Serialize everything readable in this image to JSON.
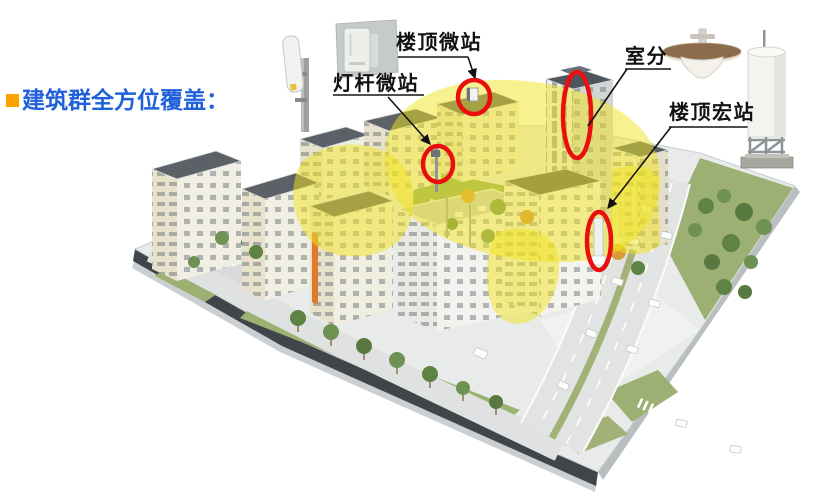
{
  "slide": {
    "title": "建筑群全方位覆盖：",
    "colors": {
      "title": "#2160DB",
      "bullet": "#FFA200",
      "marker": "#E90F0F",
      "coverage": "#F2E320"
    }
  },
  "labels": {
    "rooftop_micro": "楼顶微站",
    "pole_micro": "灯杆微站",
    "indoor": "室分",
    "rooftop_macro": "楼顶宏站"
  },
  "icons": {
    "pole_antenna": "pole-micro-antenna-icon",
    "wall_micro": "wall-mounted-micro-station-icon",
    "ceiling_antenna": "indoor-ceiling-antenna-icon",
    "macro_tower": "macro-station-cabinet-icon"
  }
}
